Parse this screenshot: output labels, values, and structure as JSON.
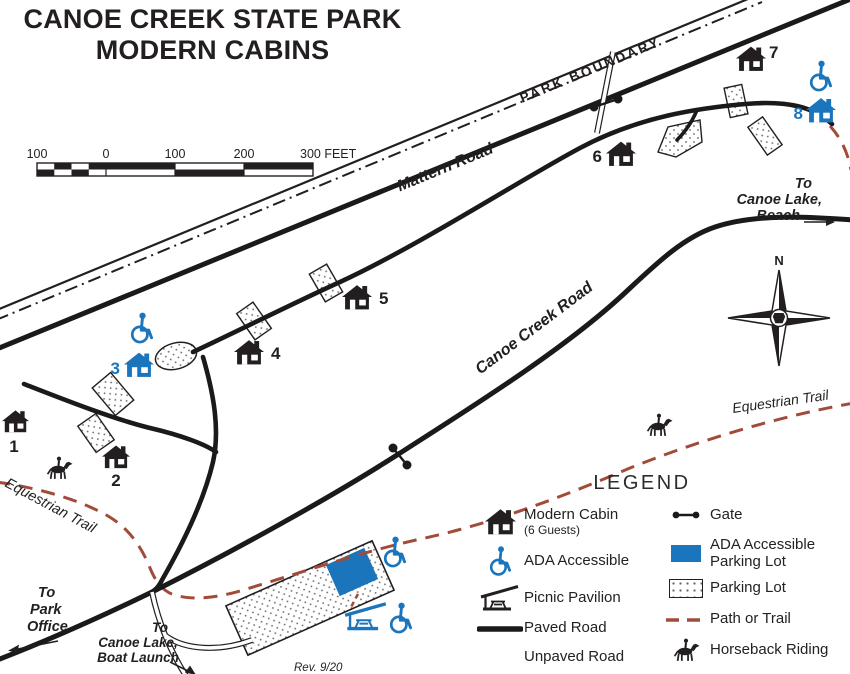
{
  "colors": {
    "accent_blue": "#1B75BC",
    "trail_brown": "#A14B3B",
    "ink": "#231F20"
  },
  "title": {
    "line1": "CANOE CREEK STATE PARK",
    "line2": "MODERN CABINS"
  },
  "scale_bar": {
    "labels": [
      "100",
      "0",
      "100",
      "200",
      "300 FEET"
    ]
  },
  "road_labels": {
    "park_boundary": "PARK BOUNDARY",
    "mattern_road": "Mattern Road",
    "canoe_creek_road": "Canoe Creek Road"
  },
  "trail_labels": {
    "equestrian_left": "Equestrian Trail",
    "equestrian_right": "Equestrian Trail"
  },
  "cabins": [
    {
      "number": "1"
    },
    {
      "number": "2"
    },
    {
      "number": "3"
    },
    {
      "number": "4"
    },
    {
      "number": "5"
    },
    {
      "number": "6"
    },
    {
      "number": "7"
    },
    {
      "number": "8"
    }
  ],
  "directions": {
    "beach": [
      "To",
      "Canoe Lake,",
      "Beach"
    ],
    "park_office": [
      "To",
      "Park",
      "Office"
    ],
    "boat_launch": [
      "To",
      "Canoe Lake,",
      "Boat Launch"
    ]
  },
  "compass": {
    "north": "N"
  },
  "revision": "Rev. 9/20",
  "legend": {
    "title": "LEGEND",
    "modern_cabin": "Modern Cabin",
    "modern_cabin_sub": "(6 Guests)",
    "ada_accessible": "ADA Accessible",
    "picnic_pavilion": "Picnic Pavilion",
    "paved_road": "Paved Road",
    "unpaved_road": "Unpaved Road",
    "gate": "Gate",
    "ada_parking_1": "ADA Accessible",
    "ada_parking_2": "Parking Lot",
    "parking_lot": "Parking Lot",
    "path_or_trail": "Path or Trail",
    "horseback_riding": "Horseback Riding"
  }
}
